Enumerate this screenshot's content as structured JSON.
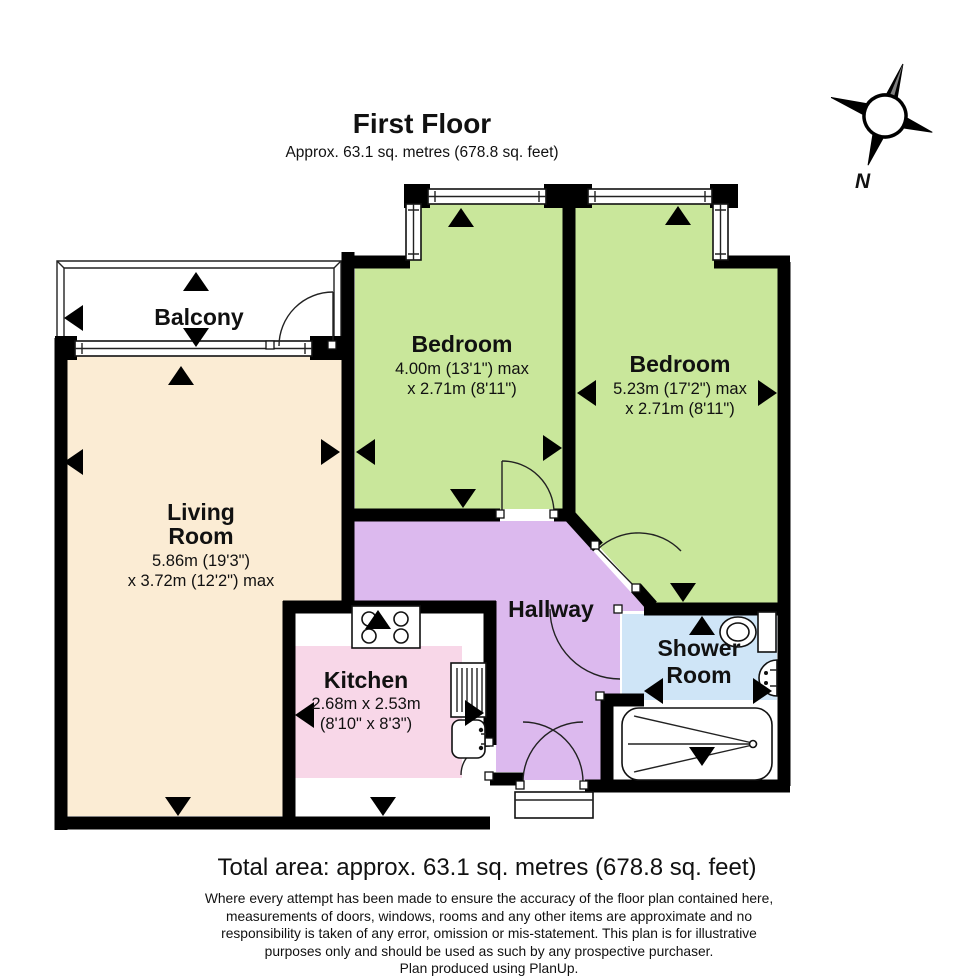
{
  "header": {
    "title": "First Floor",
    "subtitle": "Approx. 63.1 sq. metres (678.8 sq. feet)"
  },
  "compass": {
    "label": "N"
  },
  "rooms": {
    "balcony": {
      "name": "Balcony"
    },
    "bedroom1": {
      "name": "Bedroom",
      "dim1": "4.00m (13'1\") max",
      "dim2": "x 2.71m (8'11\")"
    },
    "bedroom2": {
      "name": "Bedroom",
      "dim1": "5.23m (17'2\") max",
      "dim2": "x 2.71m (8'11\")"
    },
    "living": {
      "name1": "Living",
      "name2": "Room",
      "dim1": "5.86m (19'3\")",
      "dim2": "x 3.72m (12'2\") max"
    },
    "hallway": {
      "name": "Hallway"
    },
    "kitchen": {
      "name": "Kitchen",
      "dim1": "2.68m x 2.53m",
      "dim2": "(8'10\" x 8'3\")"
    },
    "shower": {
      "name1": "Shower",
      "name2": "Room"
    }
  },
  "footer": {
    "total": "Total area: approx. 63.1 sq. metres (678.8 sq. feet)",
    "disclaimer1": "Where every attempt has been made to ensure the accuracy of the floor plan contained here,",
    "disclaimer2": "measurements of doors, windows, rooms and any other items are approximate and no",
    "disclaimer3": "responsibility is taken of any error, omission or mis-statement. This plan is for illustrative",
    "disclaimer4": "purposes only and should be used as such by any prospective purchaser.",
    "disclaimer5": "Plan produced using PlanUp."
  },
  "colors": {
    "living": "#fbecd4",
    "bedroom": "#c9e79b",
    "hallway": "#dcb9ee",
    "kitchen_accent": "#f8d7e8",
    "shower": "#cfe5f7",
    "wall": "#000000"
  }
}
